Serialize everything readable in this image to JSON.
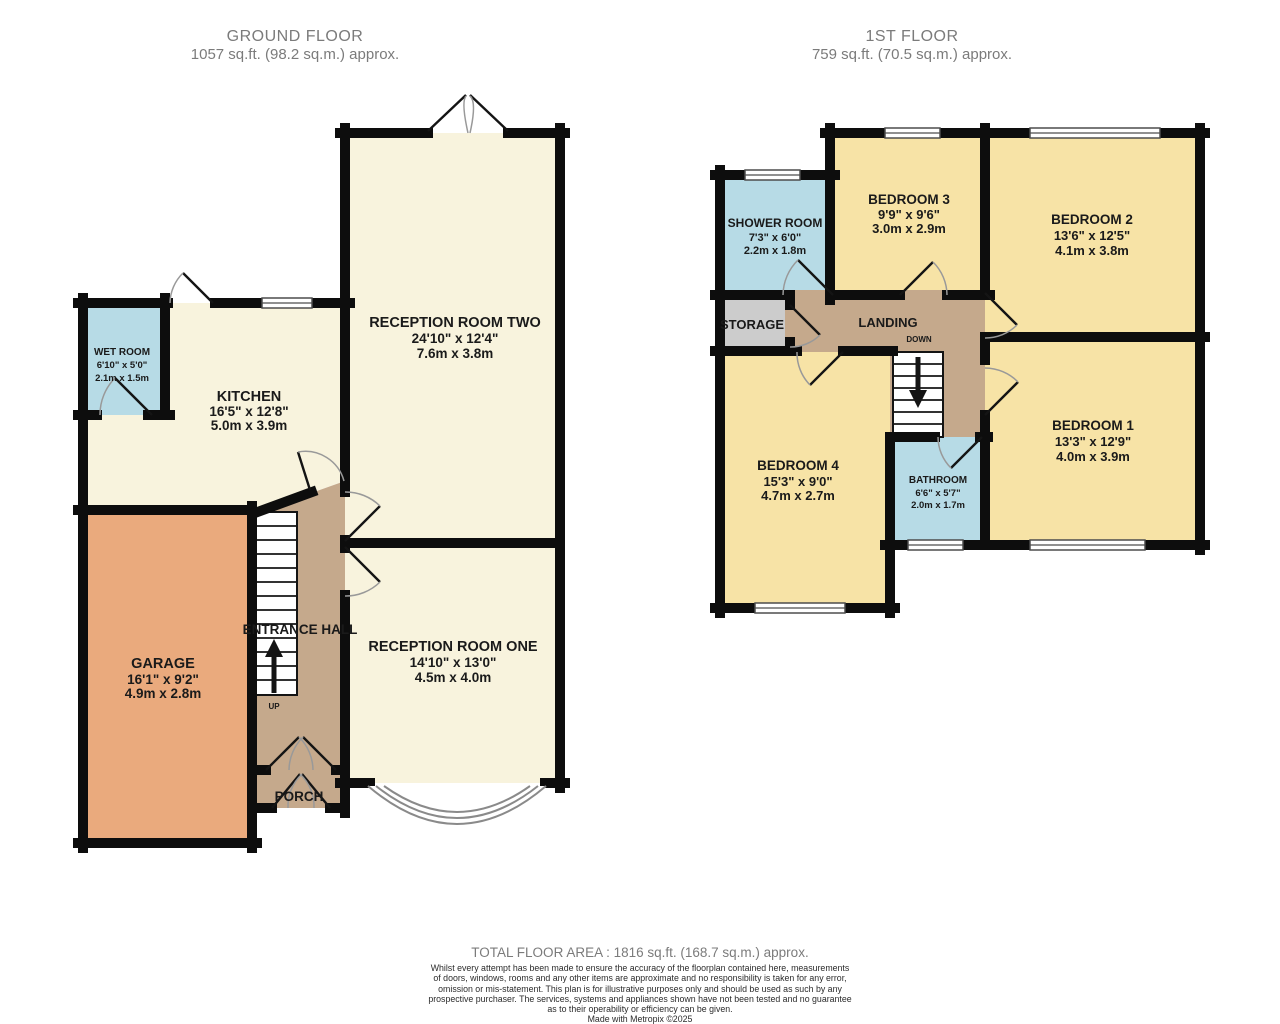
{
  "colors": {
    "wall": "#0d0d0d",
    "cream": "#f8f3dd",
    "yellow": "#f7e3a6",
    "blue": "#b7dbe6",
    "tan": "#c5a98c",
    "orange": "#eaaa7d",
    "grey_room": "#cccccc",
    "door_arc": "#999999",
    "title_text": "#7b7b7b",
    "label_text": "#1a1a1a"
  },
  "ground_floor": {
    "title": "GROUND FLOOR",
    "subtitle": "1057 sq.ft. (98.2 sq.m.) approx.",
    "rooms": {
      "wet_room": {
        "name": "WET ROOM",
        "dim_imperial": "6'10\"  x 5'0\"",
        "dim_metric": "2.1m  x 1.5m"
      },
      "kitchen": {
        "name": "KITCHEN",
        "dim_imperial": "16'5\"  x 12'8\"",
        "dim_metric": "5.0m  x 3.9m"
      },
      "reception_two": {
        "name": "RECEPTION ROOM TWO",
        "dim_imperial": "24'10\"  x 12'4\"",
        "dim_metric": "7.6m  x 3.8m"
      },
      "garage": {
        "name": "GARAGE",
        "dim_imperial": "16'1\"  x 9'2\"",
        "dim_metric": "4.9m  x 2.8m"
      },
      "entrance_hall": {
        "name": "ENTRANCE HALL"
      },
      "reception_one": {
        "name": "RECEPTION ROOM ONE",
        "dim_imperial": "14'10\"  x 13'0\"",
        "dim_metric": "4.5m  x 4.0m"
      },
      "porch": {
        "name": "PORCH"
      }
    },
    "stairs_label": "UP"
  },
  "first_floor": {
    "title": "1ST FLOOR",
    "subtitle": "759 sq.ft. (70.5 sq.m.) approx.",
    "rooms": {
      "shower_room": {
        "name": "SHOWER ROOM",
        "dim_imperial": "7'3\"  x 6'0\"",
        "dim_metric": "2.2m  x 1.8m"
      },
      "bedroom3": {
        "name": "BEDROOM 3",
        "dim_imperial": "9'9\"  x 9'6\"",
        "dim_metric": "3.0m  x 2.9m"
      },
      "bedroom2": {
        "name": "BEDROOM 2",
        "dim_imperial": "13'6\"  x 12'5\"",
        "dim_metric": "4.1m  x 3.8m"
      },
      "storage": {
        "name": "STORAGE"
      },
      "landing": {
        "name": "LANDING"
      },
      "bedroom4": {
        "name": "BEDROOM 4",
        "dim_imperial": "15'3\"  x 9'0\"",
        "dim_metric": "4.7m  x 2.7m"
      },
      "bathroom": {
        "name": "BATHROOM",
        "dim_imperial": "6'6\"  x 5'7\"",
        "dim_metric": "2.0m  x 1.7m"
      },
      "bedroom1": {
        "name": "BEDROOM 1",
        "dim_imperial": "13'3\"  x 12'9\"",
        "dim_metric": "4.0m  x 3.9m"
      }
    },
    "stairs_label": "DOWN"
  },
  "footer": {
    "total_area": "TOTAL FLOOR AREA : 1816 sq.ft. (168.7 sq.m.) approx.",
    "disclaimer_lines": [
      "Whilst every attempt has been made to ensure the accuracy of the floorplan contained here, measurements",
      "of doors, windows, rooms and any other items are approximate and no responsibility is taken for any error,",
      "omission or mis-statement. This plan is for illustrative purposes only and should be used as such by any",
      "prospective purchaser. The services, systems and appliances shown have not been tested and no guarantee",
      "as to their operability or efficiency can be given.",
      "Made with Metropix ©2025"
    ]
  }
}
